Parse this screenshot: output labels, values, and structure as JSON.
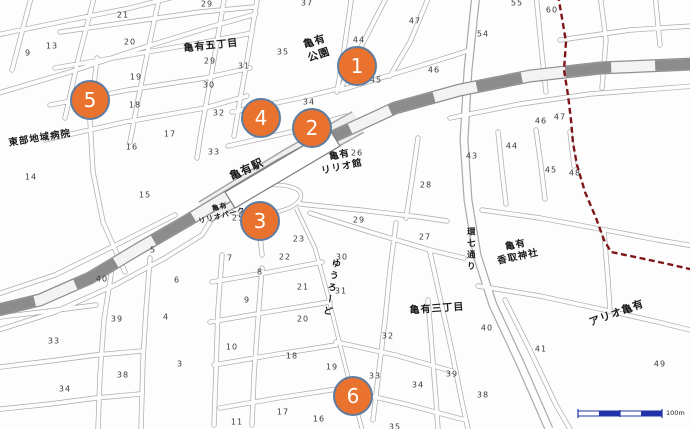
{
  "map": {
    "scale_label": "100m",
    "colors": {
      "marker_fill": "#E9732E",
      "marker_ring": "#5E7CA0",
      "railway_gray": "#8C8C8C",
      "boundary_red": "#7D1619",
      "scale_blue": "#2233AA",
      "street_casing": "#A9A9A9",
      "label_ink": "#1A1A1A"
    },
    "markers": [
      {
        "label": "1",
        "x": 357,
        "y": 66
      },
      {
        "label": "2",
        "x": 312,
        "y": 128
      },
      {
        "label": "3",
        "x": 260,
        "y": 221
      },
      {
        "label": "4",
        "x": 261,
        "y": 118
      },
      {
        "label": "5",
        "x": 90,
        "y": 100
      },
      {
        "label": "6",
        "x": 353,
        "y": 396
      }
    ],
    "place_labels": [
      {
        "id": "kameari-gochome",
        "text": "亀有五丁目",
        "x": 211,
        "y": 46,
        "rot": -6,
        "size": 10,
        "vertical": false
      },
      {
        "id": "kameari-park",
        "text": "亀有\n公園",
        "x": 317,
        "y": 49,
        "rot": -18,
        "size": 10.5,
        "vertical": false
      },
      {
        "id": "tobu-hospital",
        "text": "東部地域病院",
        "x": 40,
        "y": 139,
        "rot": -9,
        "size": 9.5,
        "vertical": false
      },
      {
        "id": "kameari-station",
        "text": "亀有駅",
        "x": 247,
        "y": 170,
        "rot": -25,
        "size": 11,
        "vertical": false
      },
      {
        "id": "kameari-lirio-kan",
        "text": "亀有\nリリオ館",
        "x": 341,
        "y": 162,
        "rot": -12,
        "size": 9.5,
        "vertical": false
      },
      {
        "id": "kameari-lirio-park",
        "text": "亀有\nリリオパーク",
        "x": 221,
        "y": 212,
        "rot": -14,
        "size": 7,
        "vertical": false
      },
      {
        "id": "kannana-dori",
        "text": "環七通り",
        "x": 470,
        "y": 250,
        "rot": 0,
        "size": 8.5,
        "vertical": true
      },
      {
        "id": "kameari-katori-shrine",
        "text": "亀有\n香取神社",
        "x": 517,
        "y": 252,
        "rot": -12,
        "size": 9.5,
        "vertical": false
      },
      {
        "id": "kameari-sanchome",
        "text": "亀有三丁目",
        "x": 437,
        "y": 309,
        "rot": -4,
        "size": 10,
        "vertical": false
      },
      {
        "id": "ario-kameari",
        "text": "アリオ亀有",
        "x": 617,
        "y": 314,
        "rot": -20,
        "size": 10.5,
        "vertical": false
      },
      {
        "id": "yu-road",
        "text": "ゆうろーど",
        "x": 330,
        "y": 288,
        "rot": 10,
        "size": 9,
        "vertical": true
      }
    ],
    "block_numbers": [
      {
        "n": "29",
        "x": 207,
        "y": 4
      },
      {
        "n": "37",
        "x": 307,
        "y": 3
      },
      {
        "n": "55",
        "x": 517,
        "y": 3
      },
      {
        "n": "60",
        "x": 552,
        "y": 10
      },
      {
        "n": "21",
        "x": 123,
        "y": 15
      },
      {
        "n": "47",
        "x": 415,
        "y": 21
      },
      {
        "n": "54",
        "x": 483,
        "y": 34
      },
      {
        "n": "44",
        "x": 359,
        "y": 40
      },
      {
        "n": "20",
        "x": 130,
        "y": 42
      },
      {
        "n": "13",
        "x": 52,
        "y": 46
      },
      {
        "n": "35",
        "x": 283,
        "y": 52
      },
      {
        "n": "9",
        "x": 28,
        "y": 53
      },
      {
        "n": "29",
        "x": 210,
        "y": 61
      },
      {
        "n": "31",
        "x": 244,
        "y": 66
      },
      {
        "n": "46",
        "x": 434,
        "y": 70
      },
      {
        "n": "19",
        "x": 136,
        "y": 77
      },
      {
        "n": "45",
        "x": 376,
        "y": 80
      },
      {
        "n": "30",
        "x": 209,
        "y": 85
      },
      {
        "n": "34",
        "x": 309,
        "y": 102
      },
      {
        "n": "18",
        "x": 135,
        "y": 105
      },
      {
        "n": "32",
        "x": 219,
        "y": 113
      },
      {
        "n": "47",
        "x": 560,
        "y": 117
      },
      {
        "n": "46",
        "x": 541,
        "y": 121
      },
      {
        "n": "17",
        "x": 170,
        "y": 134
      },
      {
        "n": "44",
        "x": 512,
        "y": 146
      },
      {
        "n": "16",
        "x": 132,
        "y": 147
      },
      {
        "n": "33",
        "x": 214,
        "y": 152
      },
      {
        "n": "26",
        "x": 357,
        "y": 153
      },
      {
        "n": "43",
        "x": 472,
        "y": 156
      },
      {
        "n": "45",
        "x": 551,
        "y": 170
      },
      {
        "n": "48",
        "x": 575,
        "y": 173
      },
      {
        "n": "14",
        "x": 31,
        "y": 177
      },
      {
        "n": "28",
        "x": 426,
        "y": 185
      },
      {
        "n": "15",
        "x": 145,
        "y": 195
      },
      {
        "n": "25",
        "x": 238,
        "y": 218
      },
      {
        "n": "29",
        "x": 359,
        "y": 220
      },
      {
        "n": "27",
        "x": 425,
        "y": 237
      },
      {
        "n": "23",
        "x": 299,
        "y": 239
      },
      {
        "n": "5",
        "x": 153,
        "y": 250
      },
      {
        "n": "22",
        "x": 285,
        "y": 257
      },
      {
        "n": "30",
        "x": 342,
        "y": 257
      },
      {
        "n": "7",
        "x": 230,
        "y": 258
      },
      {
        "n": "8",
        "x": 260,
        "y": 272
      },
      {
        "n": "40",
        "x": 102,
        "y": 279
      },
      {
        "n": "6",
        "x": 177,
        "y": 280
      },
      {
        "n": "21",
        "x": 303,
        "y": 287
      },
      {
        "n": "31",
        "x": 341,
        "y": 291
      },
      {
        "n": "9",
        "x": 247,
        "y": 300
      },
      {
        "n": "4",
        "x": 166,
        "y": 317
      },
      {
        "n": "39",
        "x": 117,
        "y": 319
      },
      {
        "n": "20",
        "x": 303,
        "y": 319
      },
      {
        "n": "40",
        "x": 487,
        "y": 328
      },
      {
        "n": "32",
        "x": 388,
        "y": 336
      },
      {
        "n": "33",
        "x": 54,
        "y": 341
      },
      {
        "n": "10",
        "x": 232,
        "y": 347
      },
      {
        "n": "41",
        "x": 541,
        "y": 349
      },
      {
        "n": "18",
        "x": 292,
        "y": 356
      },
      {
        "n": "3",
        "x": 180,
        "y": 364
      },
      {
        "n": "49",
        "x": 660,
        "y": 364
      },
      {
        "n": "19",
        "x": 332,
        "y": 367
      },
      {
        "n": "39",
        "x": 452,
        "y": 374
      },
      {
        "n": "38",
        "x": 123,
        "y": 375
      },
      {
        "n": "33",
        "x": 375,
        "y": 376
      },
      {
        "n": "34",
        "x": 418,
        "y": 385
      },
      {
        "n": "34",
        "x": 65,
        "y": 389
      },
      {
        "n": "38",
        "x": 483,
        "y": 395
      },
      {
        "n": "17",
        "x": 283,
        "y": 412
      },
      {
        "n": "16",
        "x": 319,
        "y": 419
      },
      {
        "n": "11",
        "x": 237,
        "y": 422
      },
      {
        "n": "35",
        "x": 395,
        "y": 427
      }
    ]
  }
}
